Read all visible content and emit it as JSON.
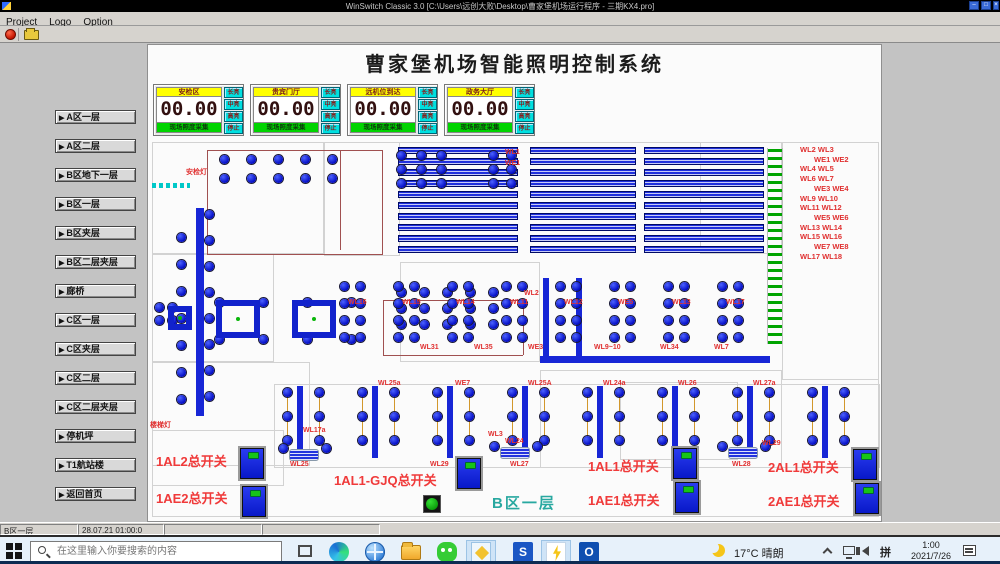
{
  "titlebar": {
    "title": "WinSwitch Classic 3.0 [C:\\Users\\远创大败\\Desktop\\曹家堡机场运行程序 - 三期KX4.pro]",
    "window_buttons": [
      "–",
      "□",
      "×"
    ]
  },
  "menubar": {
    "items": [
      "Project",
      "Logo",
      "Option"
    ]
  },
  "app": {
    "title": "曹家堡机场智能照明控制系统"
  },
  "sidebar": {
    "buttons": [
      "A区一层",
      "A区二层",
      "B区地下一层",
      "B区一层",
      "B区夹层",
      "B区二层夹层",
      "廊桥",
      "C区一层",
      "C区夹层",
      "C区二层",
      "C区二层夹层",
      "停机坪",
      "T1航站楼",
      "返回首页"
    ]
  },
  "panels": {
    "footer": "现场照度采集",
    "mode_buttons": [
      "长亮",
      "中亮",
      "高亮",
      "停止"
    ],
    "items": [
      {
        "title": "安检区",
        "value": "00.00"
      },
      {
        "title": "贵宾门厅",
        "value": "00.00"
      },
      {
        "title": "远机位到达",
        "value": "00.00"
      },
      {
        "title": "政务大厅",
        "value": "00.00"
      }
    ]
  },
  "plan": {
    "area_label": {
      "t": "B区一层",
      "x": 492,
      "y": 492
    },
    "right_list_pos": [
      800,
      145
    ],
    "right_list": [
      "WL2  WL3",
      "WE1  WE2",
      "WL4  WL5",
      "WL6  WL7",
      "WE3  WE4",
      "WL9  WL10",
      "WL11  WL12",
      "WE5  WE6",
      "WL13  WL14",
      "WL15  WL16",
      "WE7  WE8",
      "WL17  WL18"
    ],
    "labels": [
      {
        "t": "安检灯",
        "x": 186,
        "y": 167
      },
      {
        "t": "楼梯灯",
        "x": 150,
        "y": 420
      },
      {
        "t": "WL1",
        "x": 505,
        "y": 149
      },
      {
        "t": "WE1",
        "x": 505,
        "y": 160
      },
      {
        "t": "WL2",
        "x": 524,
        "y": 290
      },
      {
        "t": "WL9~10",
        "x": 594,
        "y": 344
      },
      {
        "t": "WL17a",
        "x": 303,
        "y": 427
      },
      {
        "t": "WL25a",
        "x": 378,
        "y": 380
      },
      {
        "t": "WE7",
        "x": 455,
        "y": 380
      },
      {
        "t": "WL25A",
        "x": 528,
        "y": 380
      },
      {
        "t": "WL24a",
        "x": 603,
        "y": 380
      },
      {
        "t": "WL26",
        "x": 678,
        "y": 380
      },
      {
        "t": "WL27a",
        "x": 753,
        "y": 380
      },
      {
        "t": "WL16",
        "x": 348,
        "y": 299
      },
      {
        "t": "WL15",
        "x": 402,
        "y": 299
      },
      {
        "t": "WL14",
        "x": 456,
        "y": 299
      },
      {
        "t": "WL11",
        "x": 510,
        "y": 299
      },
      {
        "t": "WL12",
        "x": 564,
        "y": 299
      },
      {
        "t": "WE5",
        "x": 618,
        "y": 299
      },
      {
        "t": "WL13",
        "x": 672,
        "y": 299
      },
      {
        "t": "WL17",
        "x": 726,
        "y": 299
      },
      {
        "t": "WL31",
        "x": 420,
        "y": 344
      },
      {
        "t": "WL35",
        "x": 474,
        "y": 344
      },
      {
        "t": "WE3",
        "x": 528,
        "y": 344
      },
      {
        "t": "WL34",
        "x": 660,
        "y": 344
      },
      {
        "t": "WL7",
        "x": 714,
        "y": 344
      },
      {
        "t": "WL24",
        "x": 505,
        "y": 438
      },
      {
        "t": "WL29",
        "x": 430,
        "y": 461
      },
      {
        "t": "WL25",
        "x": 290,
        "y": 461
      },
      {
        "t": "WL27",
        "x": 510,
        "y": 461
      },
      {
        "t": "WL28",
        "x": 732,
        "y": 461
      },
      {
        "t": "WL29",
        "x": 762,
        "y": 440
      },
      {
        "t": "WL3",
        "x": 488,
        "y": 431
      }
    ],
    "walls": [
      [
        152,
        142,
        727,
        375
      ],
      [
        152,
        142,
        172,
        112
      ],
      [
        152,
        254,
        122,
        108
      ],
      [
        152,
        362,
        158,
        104
      ],
      [
        324,
        142,
        76,
        114
      ],
      [
        400,
        262,
        140,
        100
      ],
      [
        620,
        382,
        118,
        78
      ],
      [
        700,
        142,
        82,
        112
      ],
      [
        782,
        142,
        97,
        238
      ],
      [
        540,
        370,
        242,
        98
      ],
      [
        152,
        430,
        132,
        56
      ],
      [
        274,
        384,
        606,
        84
      ]
    ],
    "brown_rects": [
      [
        207,
        150,
        176,
        105
      ]
    ],
    "brown_lines": [
      [
        383,
        300,
        140,
        1
      ],
      [
        383,
        300,
        1,
        55
      ],
      [
        523,
        300,
        1,
        55
      ],
      [
        383,
        355,
        140,
        1
      ],
      [
        340,
        150,
        1,
        100
      ]
    ],
    "cyan_ticks": [
      152,
      183
    ],
    "stripe_groups": [
      [
        398,
        147,
        120,
        10,
        11,
        7
      ],
      [
        530,
        147,
        106,
        10,
        11,
        7
      ],
      [
        644,
        147,
        120,
        10,
        11,
        7
      ]
    ],
    "green_strip": [
      767,
      148,
      16,
      196
    ],
    "solid_bars": [
      [
        196,
        208,
        8,
        208
      ],
      [
        540,
        356,
        230,
        7
      ],
      [
        543,
        278,
        6,
        82
      ],
      [
        576,
        278,
        6,
        82
      ]
    ],
    "clusters": [
      [
        220,
        155,
        5,
        2,
        27,
        19
      ],
      [
        397,
        151,
        3,
        3,
        20,
        14
      ],
      [
        489,
        151,
        2,
        3,
        18,
        14
      ],
      [
        397,
        288,
        5,
        3,
        23,
        16
      ],
      [
        215,
        298,
        4,
        2,
        44,
        37
      ],
      [
        155,
        303,
        2,
        2,
        13,
        13
      ],
      [
        340,
        282,
        2,
        4,
        16,
        17
      ],
      [
        394,
        282,
        2,
        4,
        16,
        17
      ],
      [
        448,
        282,
        2,
        4,
        16,
        17
      ],
      [
        502,
        282,
        2,
        4,
        16,
        17
      ],
      [
        556,
        282,
        2,
        4,
        16,
        17
      ],
      [
        610,
        282,
        2,
        4,
        16,
        17
      ],
      [
        664,
        282,
        2,
        4,
        16,
        17
      ],
      [
        718,
        282,
        2,
        4,
        16,
        17
      ]
    ],
    "chains": [
      [
        177,
        233,
        7,
        27
      ],
      [
        205,
        210,
        8,
        26
      ]
    ],
    "col_groups": {
      "xs": [
        283,
        358,
        433,
        508,
        583,
        658,
        733,
        808
      ],
      "y": 388
    },
    "squares": [
      [
        168,
        306,
        24,
        24
      ],
      [
        216,
        300,
        44,
        38
      ],
      [
        292,
        300,
        44,
        38
      ]
    ],
    "fixtures": [
      [
        289,
        449,
        30,
        12
      ],
      [
        500,
        447,
        30,
        12
      ],
      [
        728,
        447,
        30,
        12
      ]
    ],
    "switches": [
      [
        240,
        448
      ],
      [
        242,
        486
      ],
      [
        457,
        458
      ],
      [
        673,
        448
      ],
      [
        675,
        482
      ],
      [
        853,
        449
      ],
      [
        855,
        483
      ]
    ],
    "green_button": [
      423,
      495
    ],
    "big_labels": [
      {
        "t": "1AL2总开关",
        "x": 156,
        "y": 451
      },
      {
        "t": "1AE2总开关",
        "x": 156,
        "y": 488
      },
      {
        "t": "1AL1-GJQ总开关",
        "x": 334,
        "y": 470
      },
      {
        "t": "1AL1总开关",
        "x": 588,
        "y": 456
      },
      {
        "t": "1AE1总开关",
        "x": 588,
        "y": 490
      },
      {
        "t": "2AL1总开关",
        "x": 768,
        "y": 457
      },
      {
        "t": "2AE1总开关",
        "x": 768,
        "y": 491
      }
    ]
  },
  "statusbar": {
    "cells": [
      {
        "text": "B区一层",
        "x": 0,
        "w": 78
      },
      {
        "text": "28.07.21 01:00:0",
        "x": 78,
        "w": 86
      },
      {
        "text": "",
        "x": 164,
        "w": 98
      },
      {
        "text": "",
        "x": 262,
        "w": 118
      }
    ]
  },
  "taskbar": {
    "search_placeholder": "在这里输入你要搜索的内容",
    "icons": [
      {
        "name": "task-view-icon",
        "cls": "ic-taskview",
        "x": 290,
        "running": false,
        "active": false,
        "glyph": ""
      },
      {
        "name": "edge-icon",
        "cls": "ic-edge",
        "x": 324,
        "running": true,
        "active": false,
        "glyph": ""
      },
      {
        "name": "browser-globe-icon",
        "cls": "ic-globe",
        "x": 360,
        "running": false,
        "active": false,
        "glyph": ""
      },
      {
        "name": "file-explorer-icon",
        "cls": "ic-folder",
        "x": 396,
        "running": true,
        "active": false,
        "glyph": ""
      },
      {
        "name": "wechat-icon",
        "cls": "ic-wechat",
        "x": 432,
        "running": true,
        "active": false,
        "glyph": ""
      },
      {
        "name": "key-app-icon",
        "cls": "ic-key",
        "x": 466,
        "running": true,
        "active": true,
        "glyph": ""
      },
      {
        "name": "blue-app-icon",
        "cls": "ic-blueapp",
        "x": 508,
        "running": true,
        "active": false,
        "glyph": "S"
      },
      {
        "name": "lightning-app-icon",
        "cls": "ic-bolt",
        "x": 541,
        "running": true,
        "active": true,
        "glyph": ""
      },
      {
        "name": "outlook-icon",
        "cls": "ic-outlook",
        "x": 574,
        "running": true,
        "active": false,
        "glyph": "O"
      }
    ],
    "tray": {
      "weather": "17°C 晴朗",
      "ime": "拼",
      "time": "1:00",
      "date": "2021/7/26"
    }
  }
}
